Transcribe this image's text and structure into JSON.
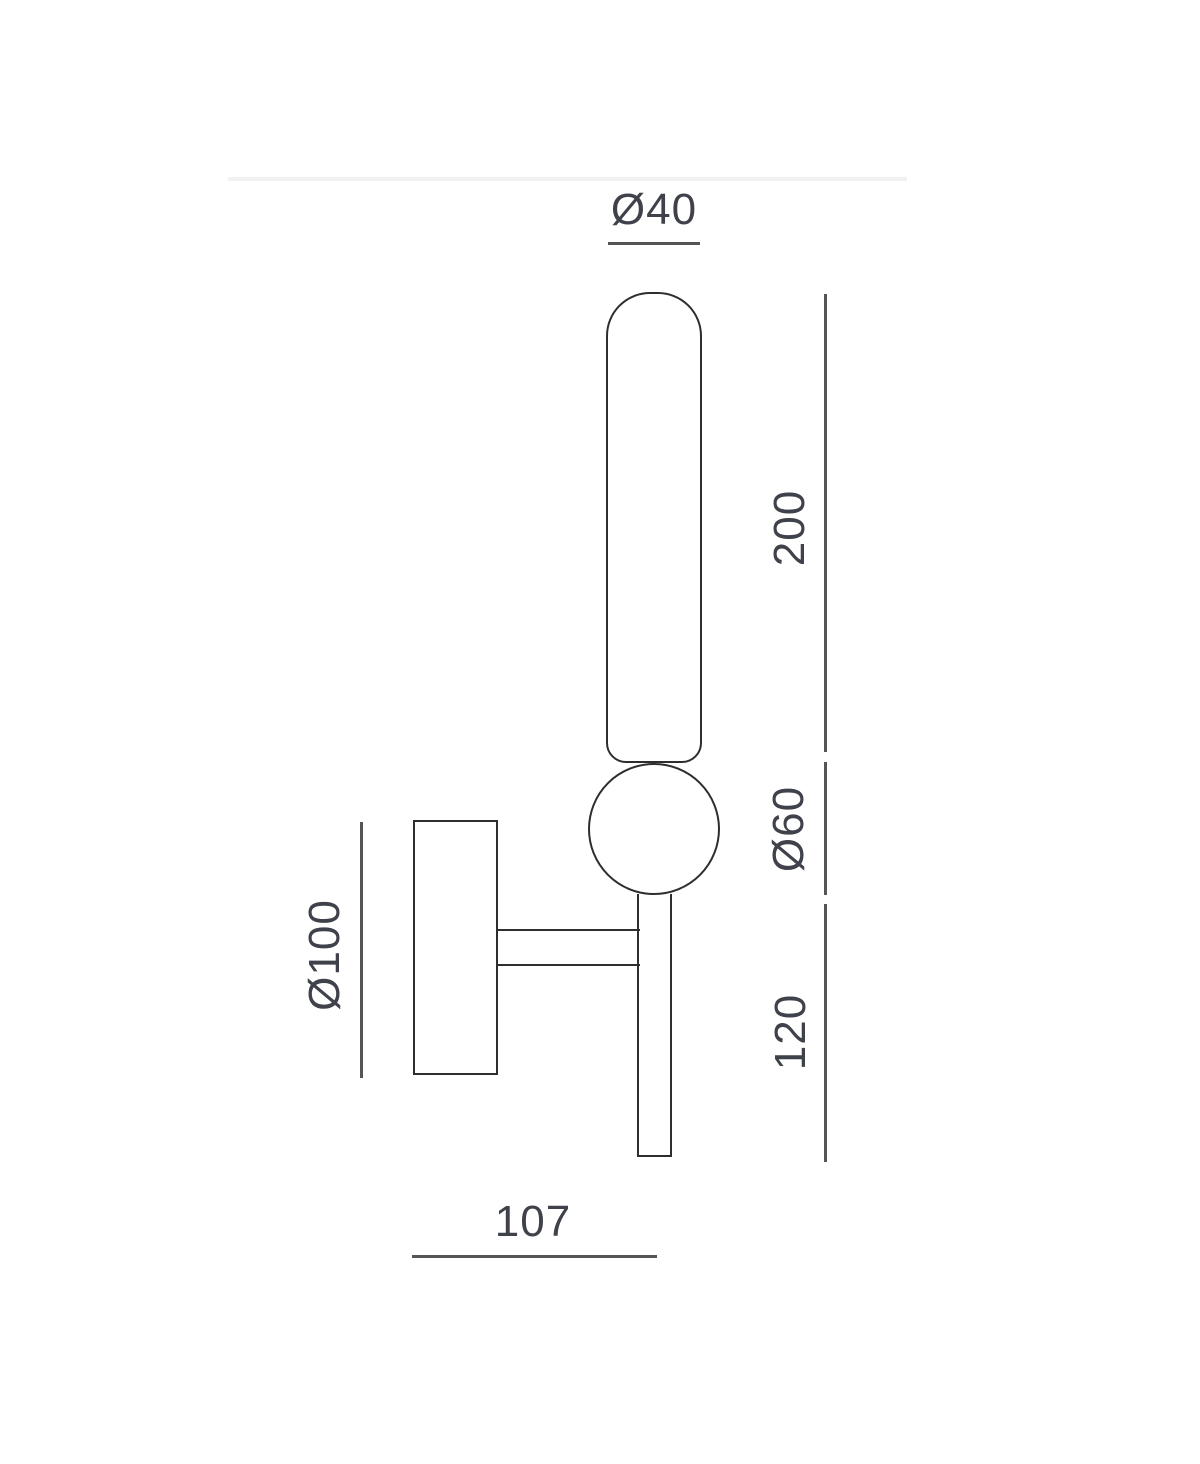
{
  "page": {
    "background_color": "#ffffff",
    "divider_color": "#f1f1f1"
  },
  "diagram": {
    "type": "technical-dimension-drawing",
    "subject": "wall lamp side elevation with dimensions",
    "colors": {
      "outline": "#2e2e2e",
      "dimension_line": "#555555",
      "label_text": "#3f424a"
    },
    "labels": {
      "tube_diameter": "Ø40",
      "tube_length": "200",
      "sphere_diameter": "Ø60",
      "stem_length": "120",
      "mount_diameter": "Ø100",
      "depth": "107"
    },
    "parts": [
      "cylindrical diffuser tube (Ø40, length 200)",
      "sphere joint (Ø60)",
      "lower stem (length 120)",
      "wall mount canopy (Ø100)",
      "mounting arm (depth 107)"
    ]
  }
}
